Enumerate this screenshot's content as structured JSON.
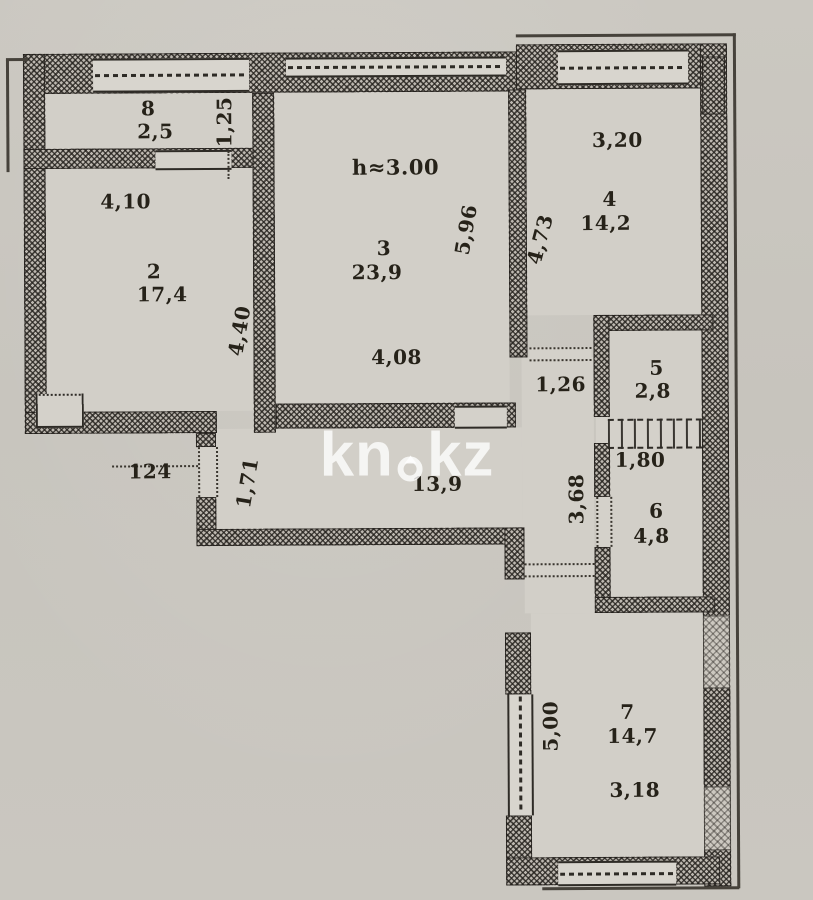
{
  "meta": {
    "description": "Scanned apartment floor plan with kn.kz watermark",
    "colors": {
      "paper": "#c9c6bf",
      "ink": "#262219",
      "room_fill": "#d2cfc8",
      "watermark": "#ffffff"
    }
  },
  "watermark": {
    "left": "kn",
    "right": "kz",
    "drop_icon": "water-drop-icon"
  },
  "plan": {
    "height_note": "h≈3.00",
    "rooms": {
      "hall": {
        "area": "13,9"
      },
      "r2": {
        "number": "2",
        "area": "17,4"
      },
      "r3": {
        "number": "3",
        "area": "23,9"
      },
      "r4": {
        "number": "4",
        "area": "14,2"
      },
      "r5": {
        "number": "5",
        "area": "2,8"
      },
      "r6": {
        "number": "6",
        "area": "4,8"
      },
      "r7": {
        "number": "7",
        "area": "14,7"
      },
      "r8": {
        "number": "8",
        "area": "2,5"
      }
    },
    "dimensions": {
      "d1_25": "1,25",
      "d4_10": "4,10",
      "d4_40": "4,40",
      "d5_96": "5,96",
      "d4_08": "4,08",
      "d4_73": "4,73",
      "d3_20": "3,20",
      "d1_26": "1,26",
      "d1_80": "1,80",
      "d3_68": "3,68",
      "d1_24": "124",
      "d1_71": "1,71",
      "d5_00": "5,00",
      "d3_18": "3,18"
    }
  }
}
